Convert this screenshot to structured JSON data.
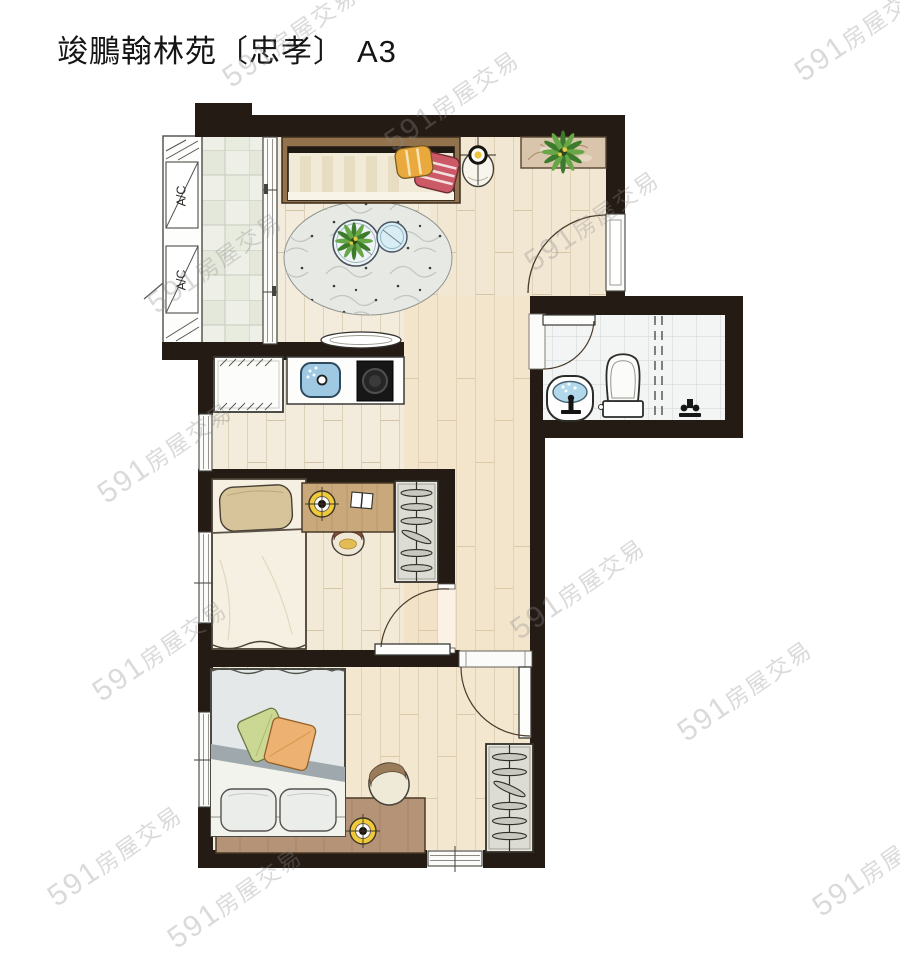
{
  "title": {
    "project": "竣鵬翰林苑〔忠孝〕",
    "unit": "A3"
  },
  "labels": {
    "ac": "A/C"
  },
  "watermark": {
    "brand": "591",
    "text": "房屋交易"
  },
  "palette": {
    "wall": "#241b14",
    "wood_floor": "#f3ecdc",
    "warm_floor_tint": "#f2d6ad",
    "balcony_tile": "#eef0e8",
    "bathroom_tile": "#f3f5f5",
    "water_blue": "#aed6ea",
    "lamp_yellow": "#f1ca3a",
    "sofa_cushion_orange": "#e9a93c",
    "sofa_blanket_red": "#cc5a66",
    "pillow_green": "#cbd894",
    "pillow_orange": "#edb271",
    "duvet_gray": "#e4e8e8",
    "rug_gray": "#e7e9e4",
    "desk_wood": "#c9a87b",
    "plant_green": "#3c7b2b"
  }
}
